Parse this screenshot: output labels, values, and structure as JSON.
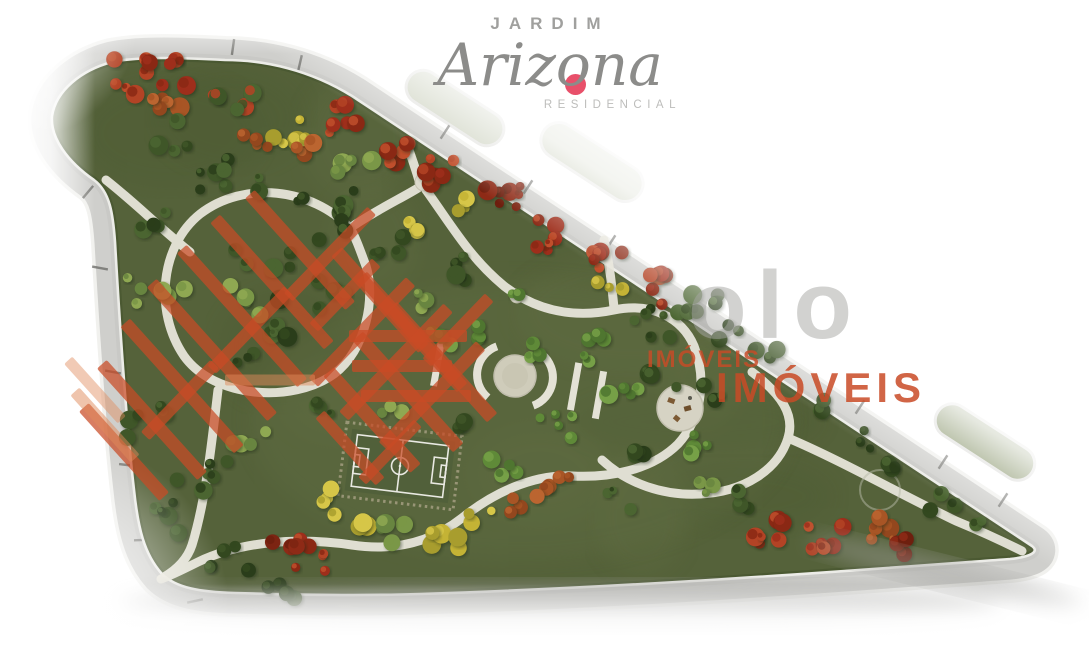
{
  "page": {
    "width": 1089,
    "height": 650,
    "background": "#ffffff"
  },
  "logo": {
    "line1": "JARDIM",
    "name": "Arizona",
    "line3": "RESIDENCIAL",
    "name_color": "#8c8c8a",
    "line1_color": "#a0a09e",
    "line3_color": "#bdbdbb",
    "accent_dot_color": "#e8506a"
  },
  "watermarks": {
    "gray_partial_text": "olo",
    "gray_color": "#a6a6a3",
    "imoveis_small": "IMÓVEIS",
    "imoveis_large": "IMÓVEIS",
    "orange_color": "#c94b26"
  },
  "site_plan": {
    "subject": "aerial rendering of triangular residential park",
    "park_green": "#55623a",
    "road_gray": "#d2d2cf",
    "curb_white": "#f1f1ee",
    "path_white": "#e7e5da",
    "plaza_beige": "#cfccba",
    "features": [
      "perimeter-road",
      "lot-tick-marks",
      "walking-path-loop",
      "winding-paths",
      "soccer-field",
      "central-mosaic-plaza",
      "gazebo-plaza",
      "tree-clusters",
      "flowering-red-trees",
      "yellow-trees",
      "palm-trees",
      "road-islands"
    ]
  }
}
